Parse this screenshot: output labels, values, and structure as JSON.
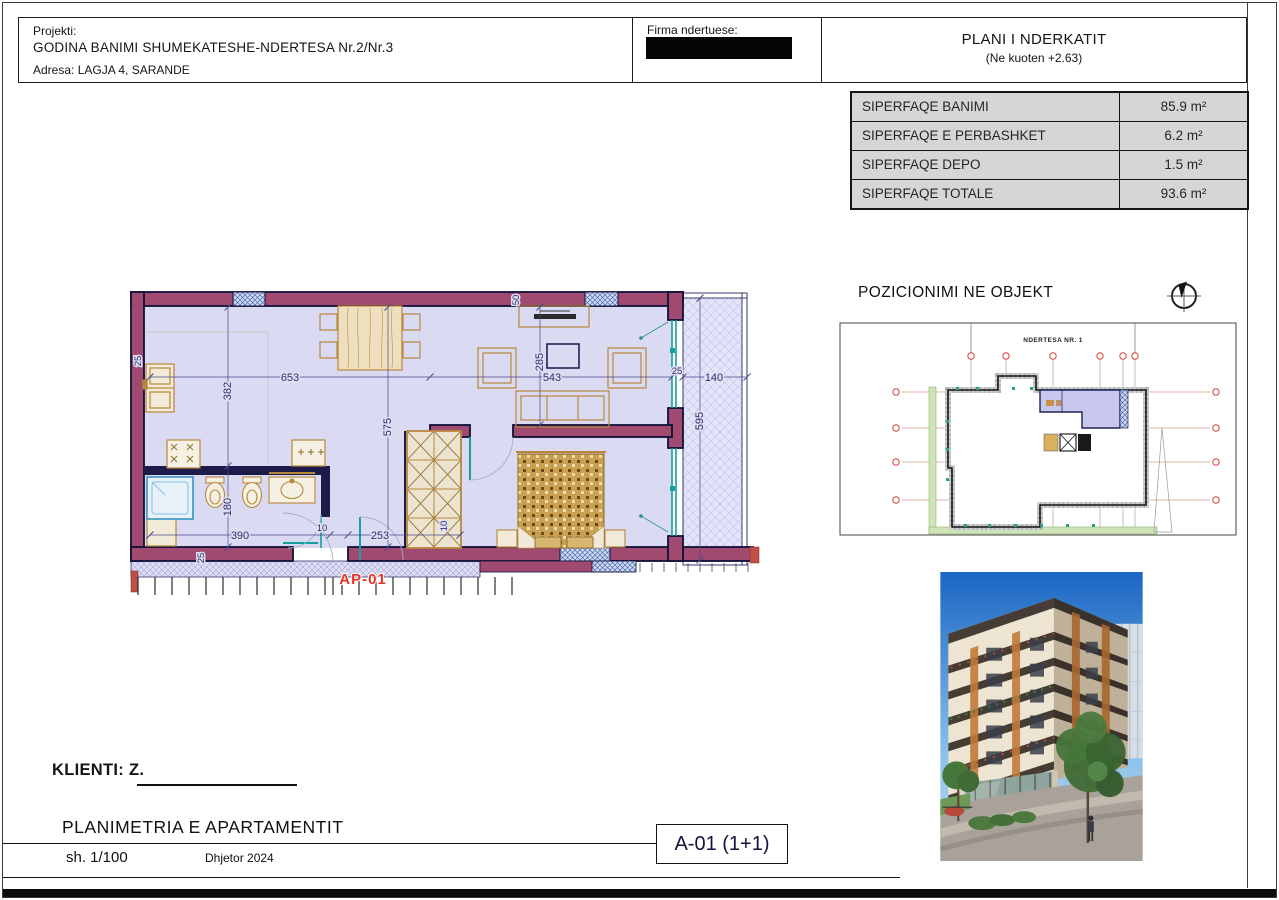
{
  "header": {
    "project_label": "Projekti:",
    "project_name": "GODINA BANIMI SHUMEKATESHE-NDERTESA Nr.2/Nr.3",
    "address": "Adresa: LAGJA 4, SARANDE",
    "firm_label": "Firma ndertuese:",
    "plan_title": "PLANI I NDERKATIT",
    "plan_subtitle": "(Ne kuoten +2.63)"
  },
  "area_table": {
    "rows": [
      {
        "label": "SIPERFAQE BANIMI",
        "value": "85.9 m²"
      },
      {
        "label": "SIPERFAQE E PERBASHKET",
        "value": "6.2 m²"
      },
      {
        "label": "SIPERFAQE DEPO",
        "value": "1.5 m²"
      },
      {
        "label": "SIPERFAQE TOTALE",
        "value": "93.6 m²"
      }
    ]
  },
  "floor_plan": {
    "unit_label": "AP-01",
    "dims": {
      "w_living": "653",
      "w_tv": "543",
      "w_gap": "25",
      "w_balcony": "140",
      "h_kitchen": "382",
      "h_bath": "180",
      "h_mid": "575",
      "h_tv": "285",
      "h_balcony": "595",
      "w_bath": "390",
      "w_door": "10",
      "w_hall": "253",
      "t_left": "25",
      "t_bottom": "25",
      "t_top": "50",
      "w_closet": "10"
    }
  },
  "site_plan": {
    "heading": "POZICIONIMI NE OBJEKT",
    "building_label": "NDERTESA NR. 1"
  },
  "footer": {
    "client_label": "KLIENTI: Z.",
    "drawing_title": "PLANIMETRIA E APARTAMENTIT",
    "scale": "sh. 1/100",
    "date": "Dhjetor 2024",
    "sheet_code": "A-01 (1+1)"
  },
  "colors": {
    "wall": "#a14a70",
    "wall_outline": "#10103a",
    "floor": "#dadaf2",
    "glass": "#14a0a0",
    "dimension": "#2e2e6e",
    "unit_label_red": "#e63326",
    "furniture": "#b8873c",
    "table_fill": "#d6d6d6"
  }
}
